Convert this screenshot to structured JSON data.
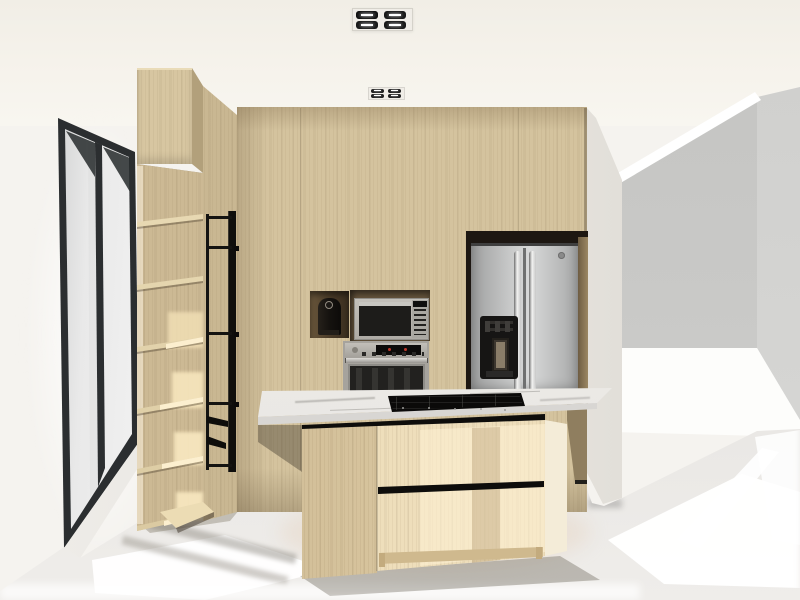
{
  "meta": {
    "title": "Kitchen interior — 3D architectural render",
    "view": "one-point perspective, no visible text in image"
  },
  "colors": {
    "wall_white": "#f5f3ef",
    "ceiling": "#f3f0e9",
    "wood_wall": "#d4c39e",
    "wood_corner": "#c9b792",
    "wood_cabinet": "#d7c6a1",
    "wood_cabinet_side": "#b2a07b",
    "wood_shelf": "#ecddb6",
    "wood_shelf_lit": "#fcefcf",
    "wood_island": "#eedebb",
    "wood_island_lit": "#f6ebd0",
    "wood_island_shade": "#d7c49c",
    "marble_top": "#edebe7",
    "marble_face": "#dedcd9",
    "black_accent": "#0e0d0b",
    "niche_brown": "#63523a",
    "steel_light": "#d6d7d7",
    "steel_mid": "#b9babb",
    "steel_dark": "#8f9091",
    "appliance_glass": "#1d1c1a",
    "window_frame": "#2b2e30",
    "floor": "#e4e3e0",
    "sun_white": "#ffffff",
    "opening_gray": "#c8c8c6",
    "opening_gray2": "#d3d3d1"
  },
  "scene": {
    "ceiling": {
      "label": "white ceiling",
      "lights": [
        {
          "label": "recessed multi-spot light (near)",
          "modules": 4
        },
        {
          "label": "recessed multi-spot light (far)",
          "modules": 4
        }
      ]
    },
    "left_wall": {
      "label": "white side wall",
      "window": {
        "label": "tall black-framed window with daylight",
        "panes": 2,
        "frame": "black"
      }
    },
    "tall_cabinet": {
      "label": "tall wood cabinet with open shelves",
      "shelves": 6,
      "drawers": 2,
      "accent": "black metal frame",
      "lighting": "sun patches on shelves"
    },
    "back_wall": {
      "label": "wood-paneled feature wall",
      "material": "light oak-look panels"
    },
    "appliances": {
      "coffee_machine": {
        "label": "black coffee machine in wall niche"
      },
      "microwave": {
        "label": "built-in stainless microwave in niche"
      },
      "oven": {
        "label": "built-in stainless wall oven with dark glass door"
      },
      "refrigerator": {
        "label": "stainless side-by-side refrigerator",
        "dispenser": "black ice/water dispenser on left door",
        "badge": "round brand badge, top of right door"
      }
    },
    "island": {
      "label": "kitchen island",
      "countertop": "white marble-look slab",
      "cooktop": {
        "label": "black gas cooktop",
        "type": "gas"
      },
      "base": "light wood with black recessed pulls and toe kick"
    },
    "right_side": {
      "label": "wall opening to adjacent bright room",
      "back_panel": "gray wall in shadow",
      "light": "bright daylight spill on floor"
    },
    "floor": {
      "label": "light gray floor with sunlight patches"
    }
  }
}
